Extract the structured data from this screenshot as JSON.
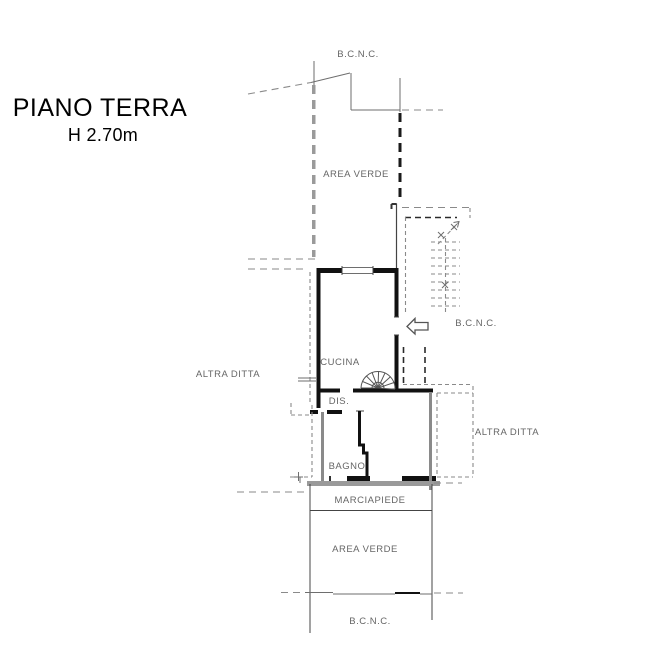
{
  "title": {
    "line1": "PIANO TERRA",
    "line2": "H 2.70m"
  },
  "labels": {
    "bcnc_top": "B.C.N.C.",
    "area_verde_top": "AREA VERDE",
    "bcnc_right": "B.C.N.C.",
    "cucina": "CUCINA",
    "altra_ditta_left": "ALTRA DITTA",
    "dis": "DIS.",
    "altra_ditta_right": "ALTRA DITTA",
    "bagno": "BAGNO",
    "marciapiede": "MARCIAPIEDE",
    "area_verde_bottom": "AREA VERDE",
    "bcnc_bottom": "B.C.N.C."
  },
  "colors": {
    "background": "#ffffff",
    "wall_black": "#111111",
    "wall_gray": "#8a8a8a",
    "line_gray": "#6e6e6e",
    "label_text": "#666666",
    "title_text": "#000000"
  }
}
